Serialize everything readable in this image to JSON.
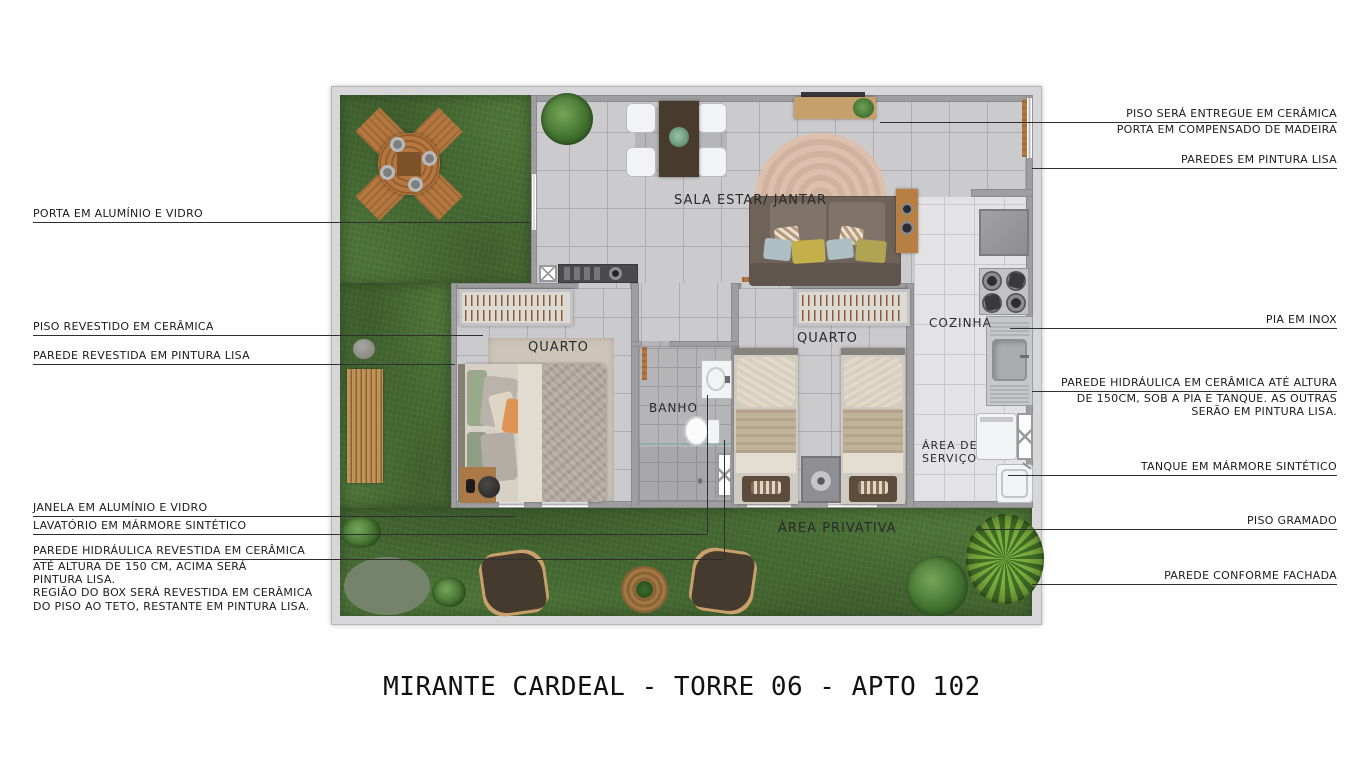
{
  "title": "MIRANTE CARDEAL - TORRE 06 - APTO 102",
  "plan": {
    "rooms": {
      "living": "SALA ESTAR/ JANTAR",
      "bedroom1": "QUARTO",
      "bedroom2": "QUARTO",
      "bathroom": "BANHO",
      "kitchen": "COZINHA",
      "service_area": "ÁREA DE SERVIÇO",
      "private_area": "ÁREA PRIVATIVA"
    }
  },
  "callouts_left": [
    {
      "text": "PORTA EM ALUMÍNIO E VIDRO"
    },
    {
      "text": "PISO REVESTIDO EM CERÂMICA"
    },
    {
      "text": "PAREDE REVESTIDA EM PINTURA LISA"
    },
    {
      "text": "JANELA EM ALUMÍNIO E VIDRO"
    },
    {
      "text": "LAVATÓRIO EM MÁRMORE SINTÉTICO"
    },
    {
      "text": "PAREDE HIDRÁULICA REVESTIDA EM CERÂMICA",
      "extra": [
        "ATÉ ALTURA DE 150 CM, ACIMA SERÁ",
        "PINTURA LISA.",
        "REGIÃO DO BOX SERÁ REVESTIDA EM CERÂMICA",
        "DO PISO AO TETO, RESTANTE EM PINTURA LISA."
      ]
    }
  ],
  "callouts_right": [
    {
      "text": "PISO SERÁ ENTREGUE EM CERÂMICA",
      "extra": [
        "PORTA EM COMPENSADO DE MADEIRA"
      ]
    },
    {
      "text": "PAREDES EM PINTURA LISA"
    },
    {
      "text": "PIA EM INOX"
    },
    {
      "text": "PAREDE HIDRÁULICA EM CERÂMICA ATÉ ALTURA",
      "extra": [
        "DE 150CM, SOB A PIA E TANQUE. AS OUTRAS",
        "SERÃO EM PINTURA LISA."
      ]
    },
    {
      "text": "TANQUE EM MÁRMORE SINTÉTICO"
    },
    {
      "text": "PISO GRAMADO"
    },
    {
      "text": "PAREDE CONFORME FACHADA"
    }
  ],
  "colors": {
    "grass": "#4c7437",
    "floor_tile": "#cbcbcd",
    "kitchen_tile": "#e3e3e5",
    "bathroom_tile": "#b5b5b7",
    "wall": "#9e9ea0",
    "wood": "#b5773f",
    "rug": "#d9bca9",
    "leader_line": "#2f2f2f"
  }
}
